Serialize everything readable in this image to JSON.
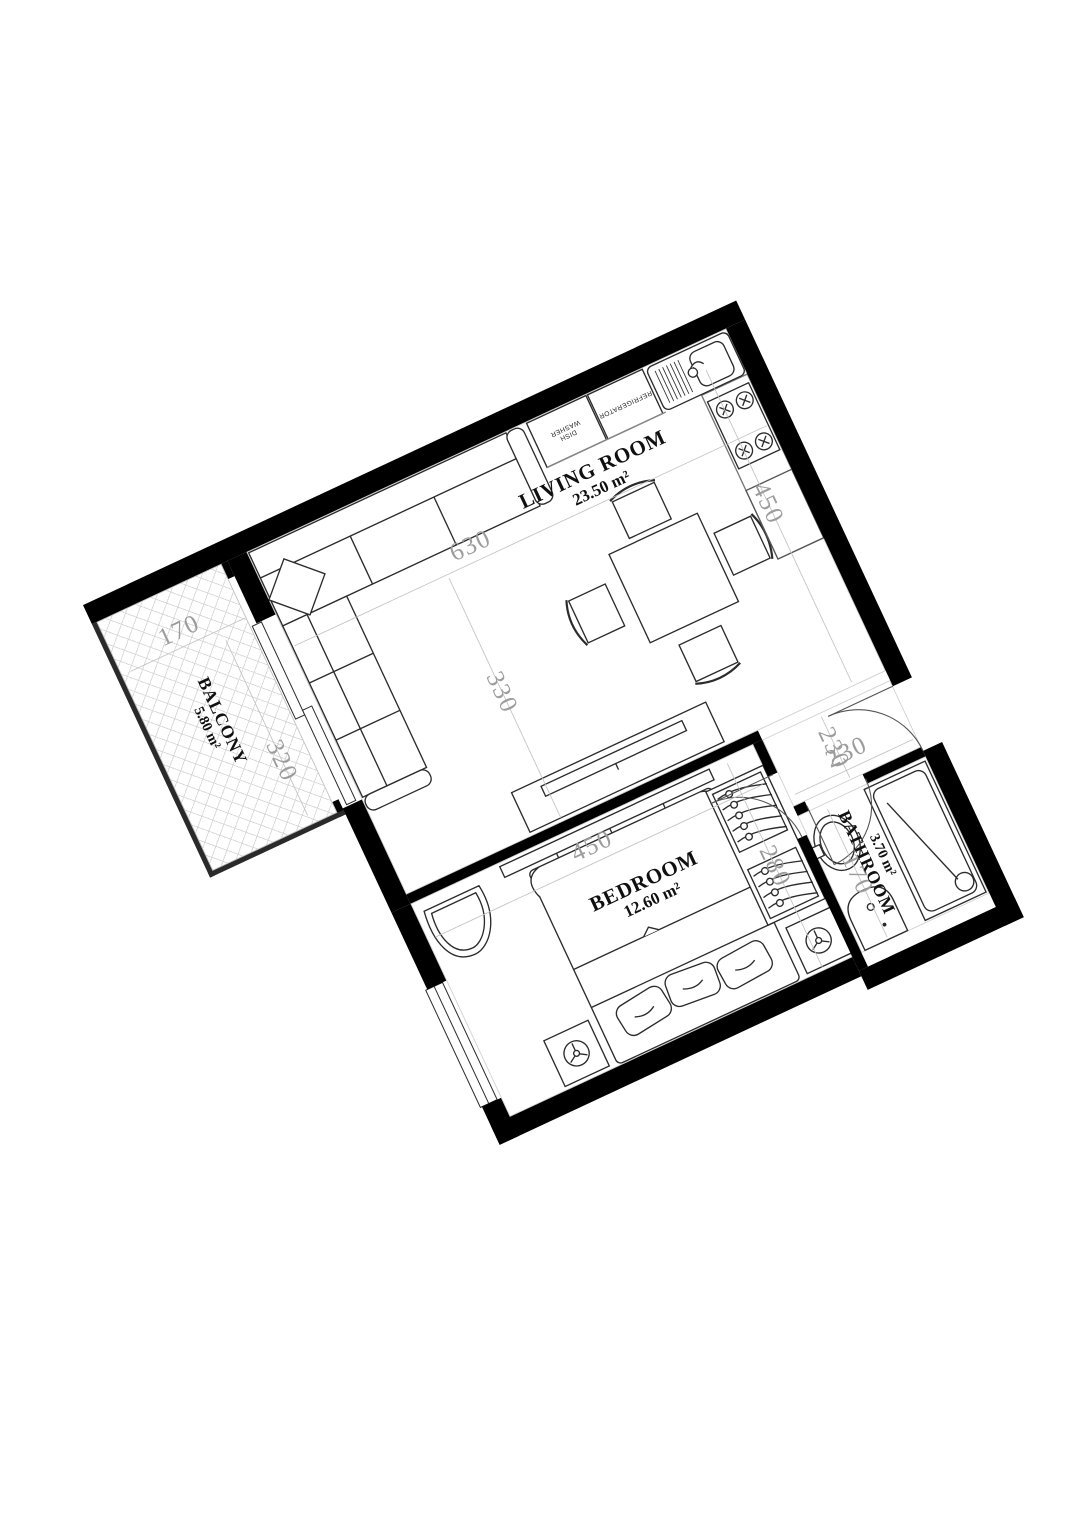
{
  "plan": {
    "type": "apartment-floor-plan",
    "wall_color": "#000000",
    "dimension_color": "#9c9c9c",
    "rooms": {
      "living": {
        "name": "LIVING ROOM",
        "area": "23.50 m²"
      },
      "bedroom": {
        "name": "BEDROOM",
        "area": "12.60 m²"
      },
      "bathroom": {
        "name": "BATHROOM",
        "area": "3.70 m²"
      },
      "balcony": {
        "name": "BALCONY",
        "area": "5.80 m²"
      }
    },
    "dimensions": {
      "living_width": "630",
      "living_depth": "450",
      "living_partial": "330",
      "hall_depth": "230",
      "bathroom_width": "230",
      "bathroom_depth": "170",
      "bedroom_width": "450",
      "bedroom_depth": "280",
      "balcony_width": "170",
      "balcony_depth": "320"
    },
    "kitchen": {
      "appliance_left_line1": "DISH",
      "appliance_left_line2": "WASHER",
      "appliance_right": "REFRIGERATOR"
    }
  }
}
